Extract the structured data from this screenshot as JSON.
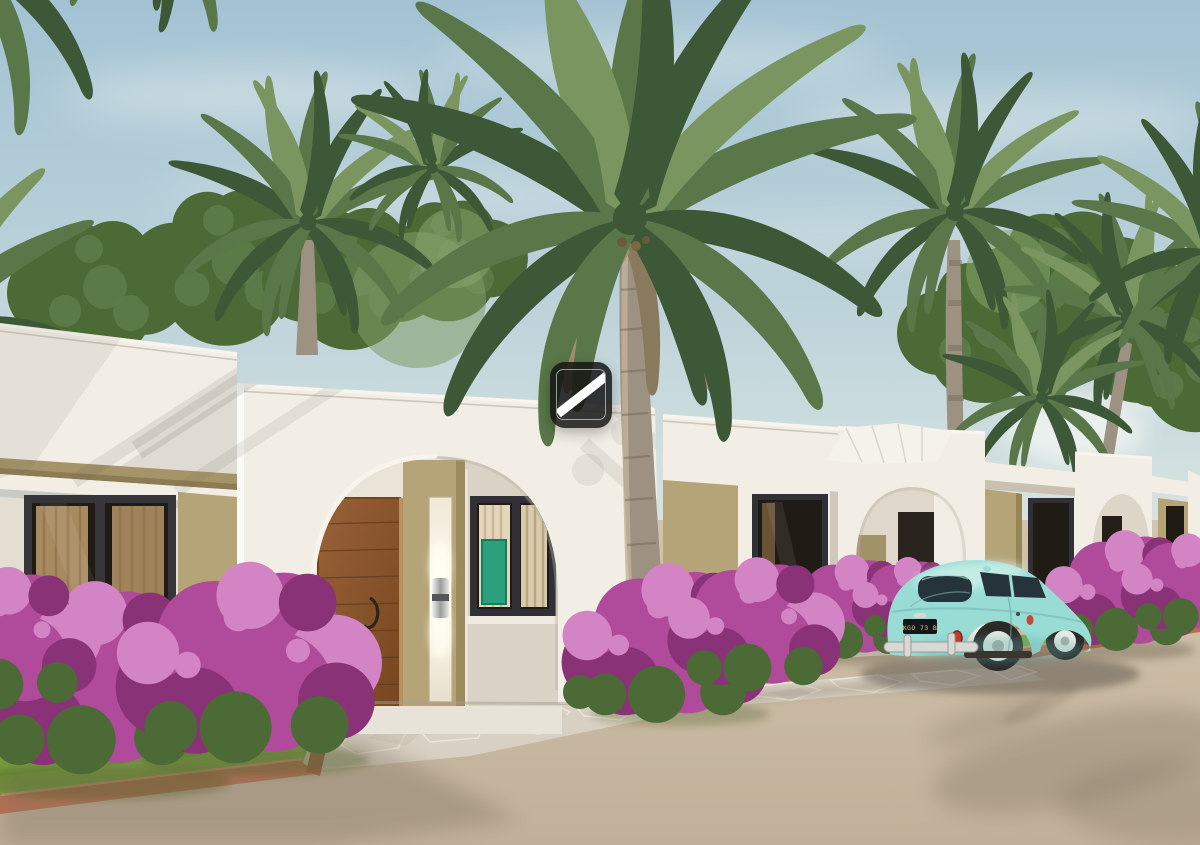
{
  "scene": {
    "type": "3d-architectural-exterior-rendering",
    "setting": "Row of white single-storey villas with arched entry porticos, olive-tan accent walls, bougainvillea planters and palm trees along a sand-coloured road under a hazy blue sky",
    "house_features": [
      "flat parapet roofs with light cornice",
      "arched entry portals",
      "dark-framed windows with tan curtains",
      "wooden front door",
      "vertical wall sconce on olive pillar",
      "green artwork visible through window"
    ],
    "visible_porticos": 4,
    "car": {
      "style": "vintage rounded compact, Beetle-style, rear three-quarter view",
      "color_name": "turquoise mint",
      "license_plate": "KGO 73 B"
    },
    "vegetation": [
      "coconut and royal palms",
      "magenta bougainvillea shrubs",
      "lawn strips",
      "background leafy trees"
    ],
    "hardscape": [
      "flagstone walkway",
      "terracotta planter curbs",
      "sand-tan road"
    ],
    "watermark": {
      "shape": "dark rounded square with white diagonal slash",
      "position": "center"
    }
  },
  "palette": {
    "sky-top": "#a3c2d3",
    "sky-mid": "#bdd3da",
    "sky-low": "#dce6e2",
    "cloud-white": "#f3f6f3",
    "palm-dark": "#3c5836",
    "palm-mid": "#597749",
    "palm-light": "#7b9560",
    "palm-pale": "#9cb07c",
    "palm-dead": "#a2906d",
    "trunk": "#9d9181",
    "trunk-dark": "#6f6250",
    "house-white": "#f2eee6",
    "house-shade": "#e3ddd2",
    "house-dim": "#cfc8ba",
    "olive": "#b5a478",
    "olive-dark": "#968656",
    "fascia": "#a59468",
    "frame-dark": "#303036",
    "glass-dark": "#201b15",
    "curtain": "#c09d6d",
    "curtain-dark": "#8f7147",
    "art-green": "#2aa07c",
    "door-wood": "#8f5c34",
    "door-dark": "#6b4124",
    "bougainvillea": "#b04a9b",
    "bougainvillea-dark": "#8a3277",
    "bougainvillea-light": "#d384c4",
    "leaf-green": "#4c6a35",
    "grass": "#7cab3d",
    "terracotta": "#bf6b4a",
    "terracotta-light": "#e09872",
    "road": "#c9baa4",
    "road-shadow": "#857866",
    "paver": "#d8d0c2",
    "paver-line": "#f1ece2",
    "car-body": "#98dcd4",
    "car-highlight": "#d4f3ed",
    "car-shadow": "#5fa8a4",
    "chrome": "#d8d8d4",
    "tire": "#2b2a28",
    "plate-text": "#d8c878",
    "watermark-bg": "rgba(18,18,18,0.84)",
    "watermark-stroke": "rgba(255,255,255,0.55)"
  }
}
